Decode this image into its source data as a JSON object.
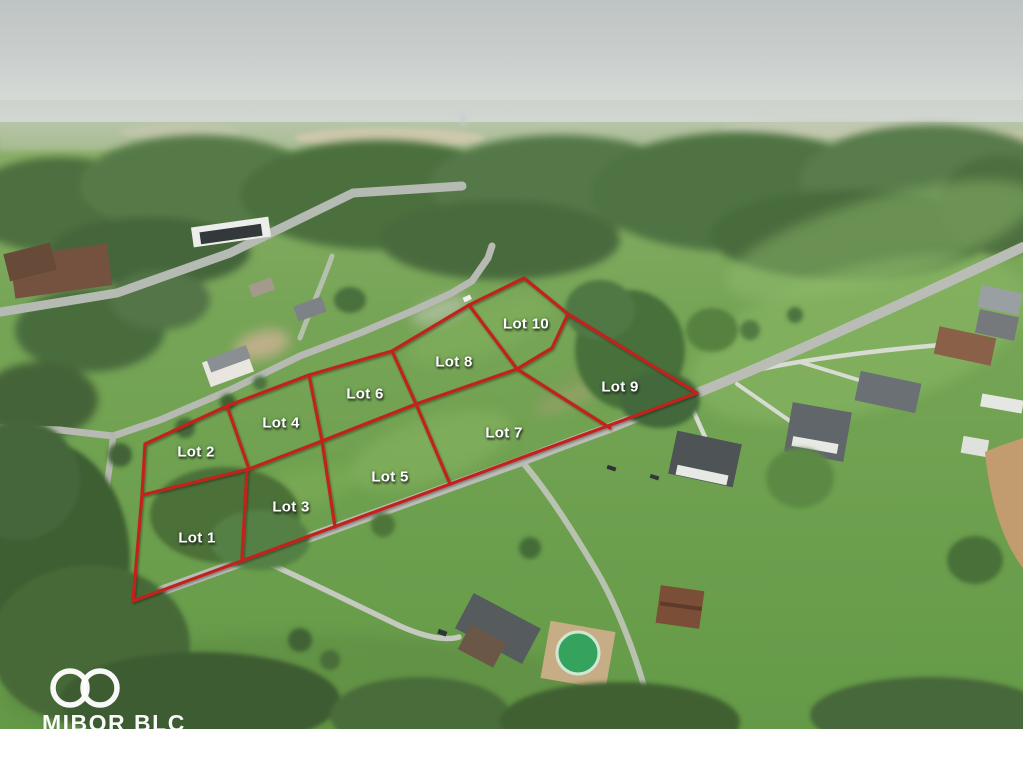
{
  "photo": {
    "type": "aerial-lot-map",
    "colors": {
      "lot_outline": "#c2221a",
      "lot_label": "#ffffff"
    },
    "lots": [
      {
        "label": "Lot 1"
      },
      {
        "label": "Lot 2"
      },
      {
        "label": "Lot 3"
      },
      {
        "label": "Lot 4"
      },
      {
        "label": "Lot 5"
      },
      {
        "label": "Lot 6"
      },
      {
        "label": "Lot 7"
      },
      {
        "label": "Lot 8"
      },
      {
        "label": "Lot 9"
      },
      {
        "label": "Lot 10"
      }
    ]
  },
  "watermark": {
    "text": "MIBOR BLC"
  }
}
